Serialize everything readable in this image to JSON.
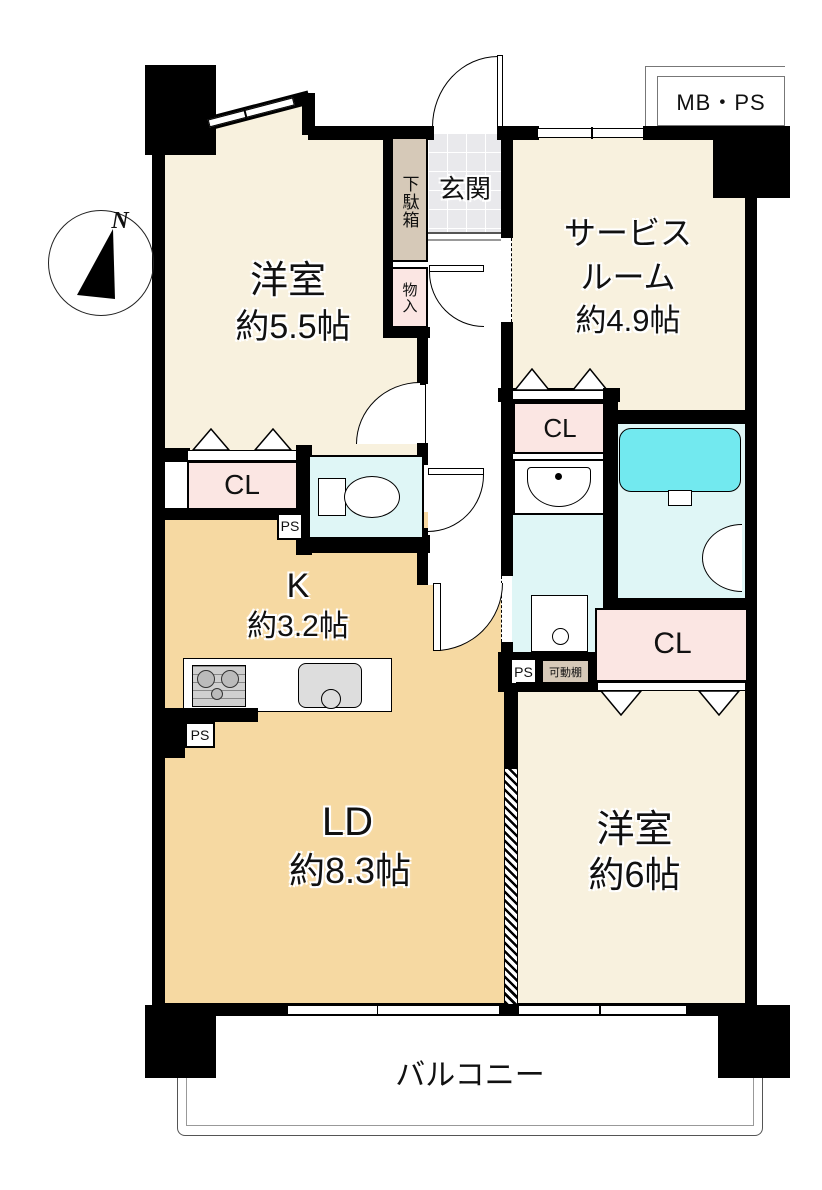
{
  "floorplan": {
    "title": "マンション間取り図",
    "compass": {
      "label": "N"
    },
    "meter_box": {
      "label": "MB・PS"
    },
    "rooms": {
      "west_room_1": {
        "name": "洋室",
        "size": "約5.5帖"
      },
      "service_room": {
        "line1": "サービス",
        "line2": "ルーム",
        "line3": "約4.9帖"
      },
      "entrance": {
        "label": "玄関"
      },
      "shoe_box": {
        "label": "下駄箱"
      },
      "storage": {
        "label": "物入"
      },
      "kitchen": {
        "name": "K",
        "size": "約3.2帖"
      },
      "living_dining": {
        "name": "LD",
        "size": "約8.3帖"
      },
      "west_room_2": {
        "name": "洋室",
        "size": "約6帖"
      },
      "balcony": {
        "label": "バルコニー"
      }
    },
    "closets": {
      "cl1": "CL",
      "cl2": "CL",
      "cl3": "CL"
    },
    "pipe_spaces": {
      "ps1": "PS",
      "ps2": "PS",
      "ps3": "PS"
    },
    "movable_shelf": {
      "label": "可動棚"
    },
    "colors": {
      "wall": "#000000",
      "room_cream": "#f8f1de",
      "kitchen_wheat": "#f6d9a2",
      "closet_pink": "#fbe6e3",
      "shoe_cabinet_tan": "#d6c9b8",
      "wet_area_cyan": "#dff6f6",
      "bathtub_cyan": "#72e9ef",
      "entrance_tile": "#e9e9ec"
    }
  }
}
